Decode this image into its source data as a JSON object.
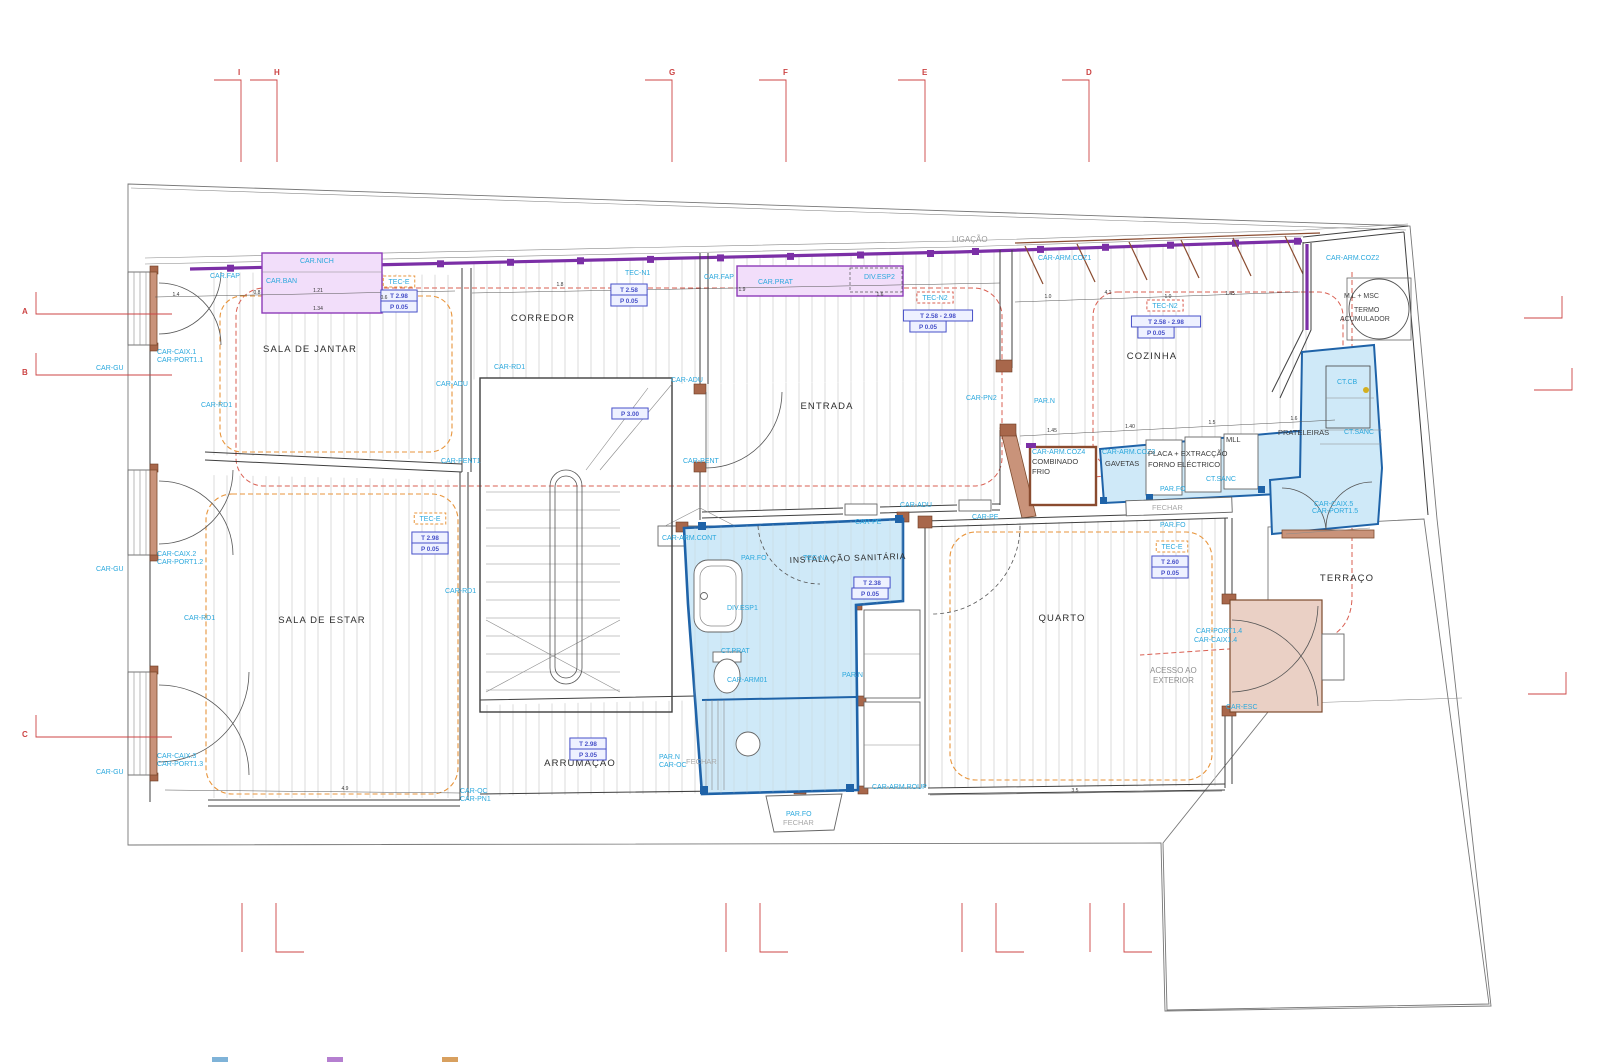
{
  "drawing": {
    "type": "architectural-floor-plan",
    "language": "pt",
    "top_note": "LIGAÇÃO"
  },
  "rooms": [
    {
      "label": "SALA DE JANTAR"
    },
    {
      "label": "CORREDOR"
    },
    {
      "label": "ENTRADA"
    },
    {
      "label": "COZINHA"
    },
    {
      "label": "SALA DE ESTAR"
    },
    {
      "label": "INSTALAÇÃO SANITÁRIA"
    },
    {
      "label": "QUARTO"
    },
    {
      "label": "ARRUMAÇÃO"
    },
    {
      "label": "TERRAÇO"
    }
  ],
  "labels": [
    {
      "t": "LIGAÇÃO",
      "x": 952,
      "y": 242,
      "cls": "gray"
    },
    {
      "t": "CAR.NICH",
      "x": 300,
      "y": 263
    },
    {
      "t": "CAR.FAP",
      "x": 210,
      "y": 278
    },
    {
      "t": "CAR.BAN",
      "x": 266,
      "y": 283
    },
    {
      "t": "CAR.FAP",
      "x": 704,
      "y": 279
    },
    {
      "t": "CAR.PRAT",
      "x": 758,
      "y": 284
    },
    {
      "t": "DIV.ESP2",
      "x": 864,
      "y": 279
    },
    {
      "t": "CAR-ARM.COZ1",
      "x": 1038,
      "y": 260
    },
    {
      "t": "CAR-ARM.COZ2",
      "x": 1326,
      "y": 260
    },
    {
      "t": "TEC-N1",
      "x": 625,
      "y": 275
    },
    {
      "t": "CAR-GU",
      "x": 96,
      "y": 370
    },
    {
      "t": "CAR-GU",
      "x": 96,
      "y": 571
    },
    {
      "t": "CAR-GU",
      "x": 96,
      "y": 774
    },
    {
      "t": "CAR-CAIX.1",
      "x": 157,
      "y": 354
    },
    {
      "t": "CAR-PORT1.1",
      "x": 157,
      "y": 362
    },
    {
      "t": "CAR-CAIX.2",
      "x": 157,
      "y": 556
    },
    {
      "t": "CAR-PORT1.2",
      "x": 157,
      "y": 564
    },
    {
      "t": "CAR-CAIX.3",
      "x": 157,
      "y": 758
    },
    {
      "t": "CAR-PORT1.3",
      "x": 157,
      "y": 766
    },
    {
      "t": "CAR-RD1",
      "x": 201,
      "y": 407
    },
    {
      "t": "CAR-RD1",
      "x": 494,
      "y": 369
    },
    {
      "t": "CAR-RD1",
      "x": 184,
      "y": 620
    },
    {
      "t": "CAR-RD1",
      "x": 445,
      "y": 593
    },
    {
      "t": "CAR-ADU",
      "x": 436,
      "y": 386
    },
    {
      "t": "CAR-ADU",
      "x": 671,
      "y": 382
    },
    {
      "t": "CAR-ADU",
      "x": 900,
      "y": 507
    },
    {
      "t": "CAR-PE",
      "x": 855,
      "y": 524
    },
    {
      "t": "CAR-PE",
      "x": 972,
      "y": 519
    },
    {
      "t": "CAR-PENT1",
      "x": 441,
      "y": 463
    },
    {
      "t": "CAR-PENT",
      "x": 683,
      "y": 463
    },
    {
      "t": "CAR-PN2",
      "x": 966,
      "y": 400
    },
    {
      "t": "PAR.N",
      "x": 1034,
      "y": 403
    },
    {
      "t": "CAR-ARM.COZ4",
      "x": 1032,
      "y": 454
    },
    {
      "t": "COMBINADO",
      "x": 1032,
      "y": 464,
      "cls": "black8"
    },
    {
      "t": "FRIO",
      "x": 1032,
      "y": 474,
      "cls": "black8"
    },
    {
      "t": "CAR-ARM.COZ3",
      "x": 1102,
      "y": 454
    },
    {
      "t": "GAVETAS",
      "x": 1105,
      "y": 466,
      "cls": "black8"
    },
    {
      "t": "PLACA + EXTRACÇÃO",
      "x": 1148,
      "y": 456,
      "cls": "black8"
    },
    {
      "t": "FORNO ELÉCTRICO",
      "x": 1148,
      "y": 467,
      "cls": "black8"
    },
    {
      "t": "MLL",
      "x": 1226,
      "y": 442,
      "cls": "black8"
    },
    {
      "t": "PRATELEIRAS",
      "x": 1278,
      "y": 435,
      "cls": "black8"
    },
    {
      "t": "CT.CB",
      "x": 1337,
      "y": 384
    },
    {
      "t": "CT.SANC",
      "x": 1344,
      "y": 434
    },
    {
      "t": "CT.SANC",
      "x": 1206,
      "y": 481
    },
    {
      "t": "PAR.FO",
      "x": 1160,
      "y": 491
    },
    {
      "t": "FECHAR",
      "x": 1152,
      "y": 510,
      "cls": "grayS"
    },
    {
      "t": "PAR.FO",
      "x": 1160,
      "y": 527
    },
    {
      "t": "M.L + MSC",
      "x": 1344,
      "y": 298,
      "cls": "black7"
    },
    {
      "t": "TERMO",
      "x": 1354,
      "y": 312,
      "cls": "black7"
    },
    {
      "t": "ACUMULADOR",
      "x": 1340,
      "y": 321,
      "cls": "black7"
    },
    {
      "t": "CAR-CAIX.5",
      "x": 1314,
      "y": 506
    },
    {
      "t": "CAR-PORT1.5",
      "x": 1312,
      "y": 513
    },
    {
      "t": "CAR-ARM.CONT",
      "x": 662,
      "y": 540
    },
    {
      "t": "PAR.FO",
      "x": 741,
      "y": 560
    },
    {
      "t": "TEC-N1",
      "x": 803,
      "y": 560
    },
    {
      "t": "DIV.ESP1",
      "x": 727,
      "y": 610
    },
    {
      "t": "CT.PRAT",
      "x": 721,
      "y": 653
    },
    {
      "t": "CAR-ARM01",
      "x": 727,
      "y": 682
    },
    {
      "t": "PAR.N",
      "x": 842,
      "y": 677
    },
    {
      "t": "CAR-ARM.ROUP",
      "x": 872,
      "y": 789
    },
    {
      "t": "PAR.N",
      "x": 659,
      "y": 759
    },
    {
      "t": "CAR-OC",
      "x": 659,
      "y": 767
    },
    {
      "t": "FECHAR",
      "x": 686,
      "y": 764,
      "cls": "grayS"
    },
    {
      "t": "PAR.FO",
      "x": 786,
      "y": 816
    },
    {
      "t": "FECHAR",
      "x": 783,
      "y": 825,
      "cls": "grayS"
    },
    {
      "t": "CAR-OC",
      "x": 460,
      "y": 793
    },
    {
      "t": "CAR-PN1",
      "x": 460,
      "y": 801
    },
    {
      "t": "ACESSO AO",
      "x": 1150,
      "y": 673,
      "cls": "gray8"
    },
    {
      "t": "EXTERIOR",
      "x": 1153,
      "y": 683,
      "cls": "gray8"
    },
    {
      "t": "CAR-PORT1.4",
      "x": 1196,
      "y": 633
    },
    {
      "t": "CAR-CAIX1.4",
      "x": 1194,
      "y": 642
    },
    {
      "t": "CAR-ESC",
      "x": 1226,
      "y": 709
    }
  ],
  "boxed_labels": [
    {
      "t": "TEC-E",
      "x": 399,
      "y": 284,
      "box": "orange"
    },
    {
      "t": "T 2.98",
      "x": 399,
      "y": 298,
      "box": "blue"
    },
    {
      "t": "P 0.05",
      "x": 399,
      "y": 309,
      "box": "blue"
    },
    {
      "t": "T 2.58",
      "x": 629,
      "y": 292,
      "box": "blue"
    },
    {
      "t": "P 0.05",
      "x": 629,
      "y": 303,
      "box": "blue"
    },
    {
      "t": "TEC-N2",
      "x": 935,
      "y": 300,
      "box": "red"
    },
    {
      "t": "T 2.58 - 2.98",
      "x": 938,
      "y": 318,
      "box": "blue"
    },
    {
      "t": "P 0.05",
      "x": 928,
      "y": 329,
      "box": "blue"
    },
    {
      "t": "TEC-N2",
      "x": 1165,
      "y": 308,
      "box": "red"
    },
    {
      "t": "T 2.58 - 2.98",
      "x": 1166,
      "y": 324,
      "box": "blue"
    },
    {
      "t": "P 0.05",
      "x": 1156,
      "y": 335,
      "box": "blue"
    },
    {
      "t": "P 3.00",
      "x": 630,
      "y": 416,
      "box": "blue"
    },
    {
      "t": "TEC-E",
      "x": 430,
      "y": 521,
      "box": "orange"
    },
    {
      "t": "T 2.98",
      "x": 430,
      "y": 540,
      "box": "blue"
    },
    {
      "t": "P 0.05",
      "x": 430,
      "y": 551,
      "box": "blue"
    },
    {
      "t": "T 2.38",
      "x": 872,
      "y": 585,
      "box": "blue"
    },
    {
      "t": "P 0.05",
      "x": 870,
      "y": 596,
      "box": "blue"
    },
    {
      "t": "T 2.98",
      "x": 588,
      "y": 746,
      "box": "blue"
    },
    {
      "t": "P 3.05",
      "x": 588,
      "y": 757,
      "box": "blue"
    },
    {
      "t": "TEC-E",
      "x": 1172,
      "y": 549,
      "box": "orange"
    },
    {
      "t": "T 2.60",
      "x": 1170,
      "y": 564,
      "box": "blue"
    },
    {
      "t": "P 0.05",
      "x": 1170,
      "y": 575,
      "box": "blue"
    }
  ],
  "grid_markers": {
    "top": [
      {
        "letter": "I",
        "x": 241
      },
      {
        "letter": "H",
        "x": 277
      },
      {
        "letter": "G",
        "x": 672
      },
      {
        "letter": "F",
        "x": 786
      },
      {
        "letter": "E",
        "x": 925
      },
      {
        "letter": "D",
        "x": 1089
      }
    ],
    "left": [
      {
        "letter": "A",
        "y": 311
      },
      {
        "letter": "B",
        "y": 372
      },
      {
        "letter": "C",
        "y": 734
      }
    ]
  },
  "dimensions": [
    {
      "t": "1.4",
      "x": 176,
      "y": 296
    },
    {
      "t": "0.8",
      "x": 257,
      "y": 294
    },
    {
      "t": "1.21",
      "x": 318,
      "y": 292
    },
    {
      "t": "1.34",
      "x": 318,
      "y": 310
    },
    {
      "t": "0.6",
      "x": 384,
      "y": 299
    },
    {
      "t": "1.8",
      "x": 560,
      "y": 286
    },
    {
      "t": "1.9",
      "x": 742,
      "y": 291
    },
    {
      "t": "1.6",
      "x": 880,
      "y": 296
    },
    {
      "t": "1.0",
      "x": 1048,
      "y": 298
    },
    {
      "t": "4.1",
      "x": 1108,
      "y": 294
    },
    {
      "t": "1.0",
      "x": 1168,
      "y": 298
    },
    {
      "t": "1.45",
      "x": 1230,
      "y": 295
    },
    {
      "t": "1.45",
      "x": 1052,
      "y": 432
    },
    {
      "t": "1.40",
      "x": 1130,
      "y": 428
    },
    {
      "t": "1.5",
      "x": 1212,
      "y": 424
    },
    {
      "t": "1.6",
      "x": 1294,
      "y": 420
    },
    {
      "t": "4.9",
      "x": 345,
      "y": 790
    },
    {
      "t": "3.5",
      "x": 1075,
      "y": 792
    }
  ],
  "legend_chips": [
    {
      "x": 212,
      "c": "#7fb3d8"
    },
    {
      "x": 327,
      "c": "#b57fd0"
    },
    {
      "x": 442,
      "c": "#d8a05f"
    }
  ],
  "colors": {
    "annotation_cyan": "#2ba8dd",
    "height_box_blue": "#4750c8",
    "carpentry_purple": "#7b2fa6",
    "sanitary_fill": "#cfe9f8",
    "sanitary_border": "#1f63a8",
    "wood_brown": "#c9937a",
    "ceiling_zone_red": "#d95f52",
    "ceiling_zone_orange": "#e8953c",
    "grid_mark_red": "#cc4444"
  }
}
